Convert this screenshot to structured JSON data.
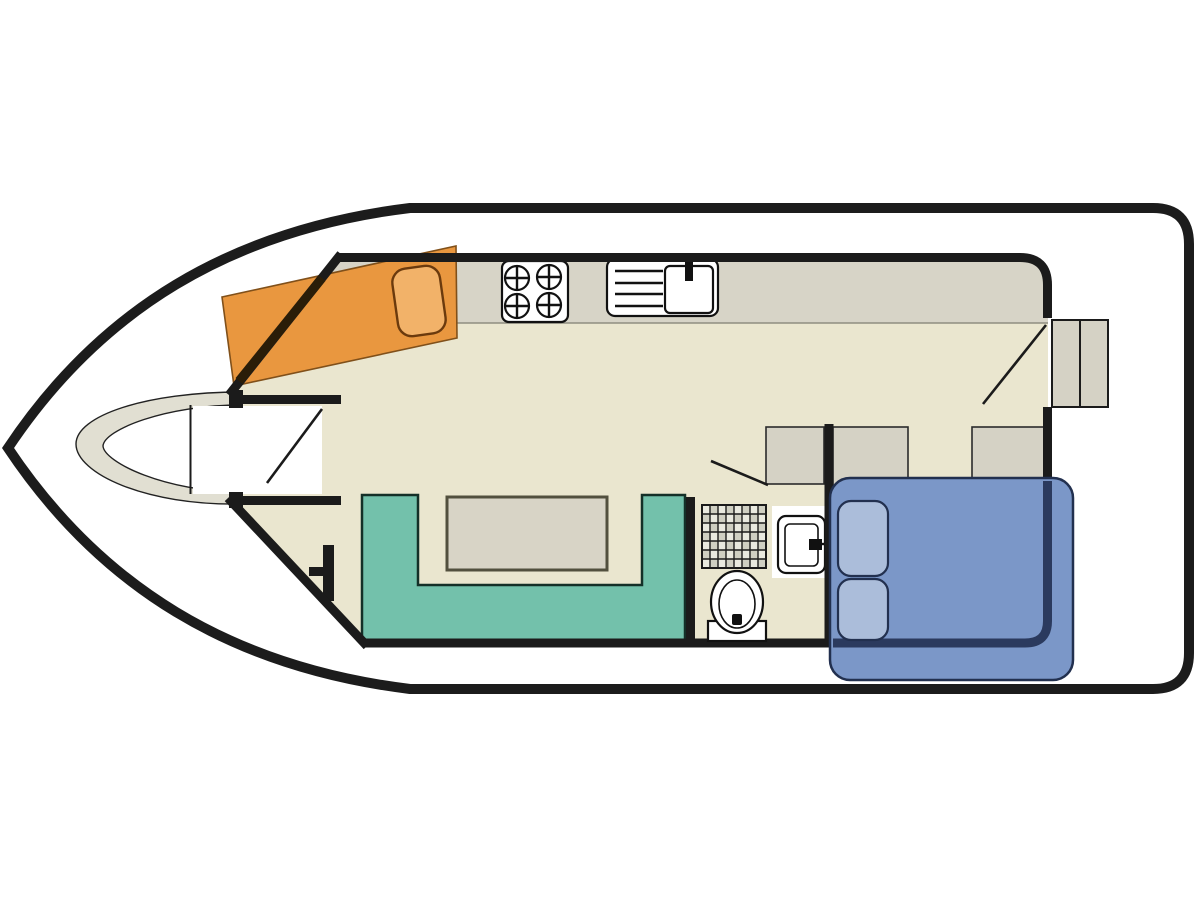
{
  "meta": {
    "title": "Houseboat floor plan",
    "type": "floorplan-diagram",
    "orientation": "bow-left-stern-right",
    "visible_text": []
  },
  "palette": {
    "hull": "#1c1c1c",
    "wall": "#1b1b1b",
    "outline": "#222222",
    "floor": "#eae6cf",
    "counter": "#d7d4c7",
    "counterEdge": "#8f8d80",
    "crescent": "#e1dfd2",
    "cabinet": "#d5d2c5",
    "cabinetEdge": "#2b2b2b",
    "bedOrange": "#e9973f",
    "bedOrangeEdge": "#80501a",
    "pillowOrange": "#f2b269",
    "pillowOrangeEdge": "#6b3a0d",
    "wallOverOrange": "#2a1d08",
    "sofa": "#73c1ab",
    "sofaEdge": "#143028",
    "table": "#d8d4c6",
    "tableEdge": "#52503e",
    "bedBlue": "#7b97c8",
    "bedBlueEdge": "#22304f",
    "pillowBlue": "#abbdda",
    "wallOverBlue": "#2b3a5e",
    "fixture": "#111111",
    "showerLine": "#1a1a1a"
  },
  "rooms": [
    {
      "name": "bow-deck",
      "features": [
        "curved bow seat",
        "entry vestibule",
        "door swing"
      ]
    },
    {
      "name": "saloon",
      "features": [
        "u-shaped sofa",
        "table",
        "mooring cleat mark"
      ]
    },
    {
      "name": "galley",
      "features": [
        "counter",
        "four-burner stove",
        "sink with drainer"
      ]
    },
    {
      "name": "bathroom",
      "features": [
        "shower grid",
        "washbasin",
        "toilet",
        "door swing"
      ]
    },
    {
      "name": "aft-cabin",
      "features": [
        "double bed",
        "two pillows",
        "two wardrobes"
      ]
    },
    {
      "name": "aft-deck",
      "features": [
        "two steps",
        "door swing"
      ]
    }
  ],
  "furniture": [
    {
      "name": "single-berth",
      "color": "bedOrange",
      "pillows": 1
    },
    {
      "name": "double-bed",
      "color": "bedBlue",
      "pillows": 2
    },
    {
      "name": "sofa",
      "color": "sofa",
      "shape": "U"
    },
    {
      "name": "table",
      "color": "table"
    },
    {
      "name": "stove",
      "burners": 4
    },
    {
      "name": "sink",
      "drainer_lines": 4
    },
    {
      "name": "shower",
      "grid": {
        "cols": 8,
        "rows": 7
      }
    },
    {
      "name": "washbasin"
    },
    {
      "name": "toilet"
    },
    {
      "name": "wardrobe-left"
    },
    {
      "name": "wardrobe-right"
    },
    {
      "name": "entry-cabinet"
    },
    {
      "name": "deck-steps",
      "count": 2
    }
  ]
}
